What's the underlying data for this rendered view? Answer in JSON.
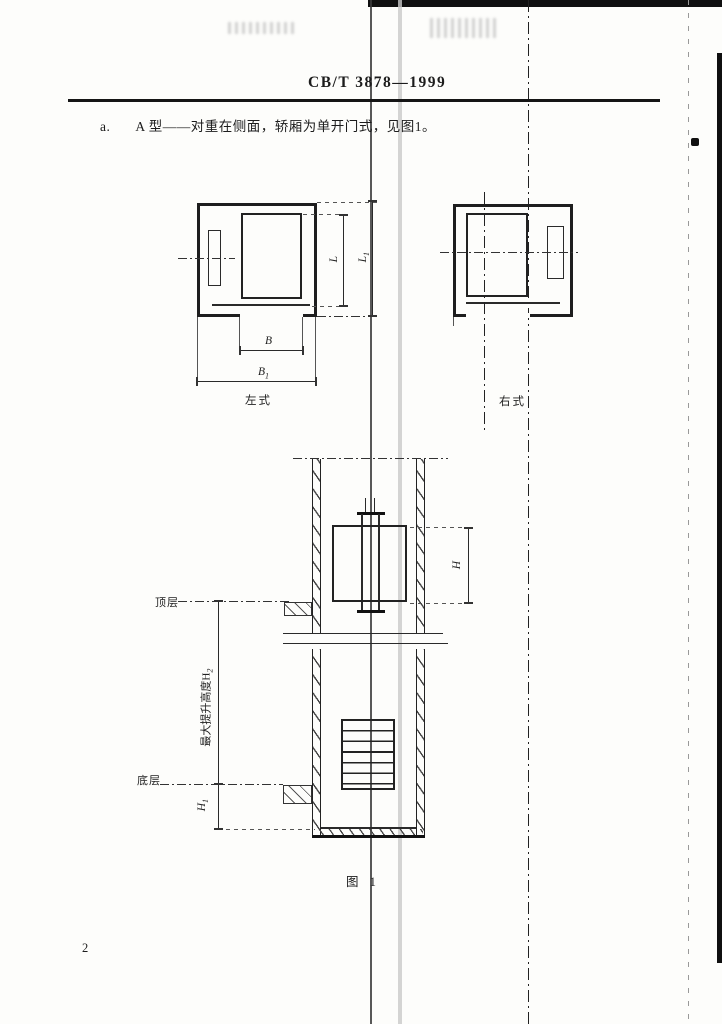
{
  "header": {
    "standard_number": "CB/T 3878—1999"
  },
  "body": {
    "item_label": "a.",
    "item_text": "A 型——对重在侧面，轿厢为单开门式，见图1。"
  },
  "figure": {
    "caption": "图 1",
    "plan_left": {
      "label": "左式"
    },
    "plan_right": {
      "label": "右式"
    },
    "dims": {
      "L": {
        "base": "L",
        "sub": ""
      },
      "L1": {
        "base": "L",
        "sub": "1"
      },
      "B": {
        "base": "B",
        "sub": ""
      },
      "B1": {
        "base": "B",
        "sub": "1"
      },
      "H": {
        "base": "H",
        "sub": ""
      },
      "H1": {
        "base": "H",
        "sub": "1"
      },
      "travel": {
        "base": "最大提升高度H",
        "sub": "2"
      }
    },
    "elevation": {
      "top_floor": "顶层",
      "bottom_floor": "底层"
    }
  },
  "page_number": "2"
}
